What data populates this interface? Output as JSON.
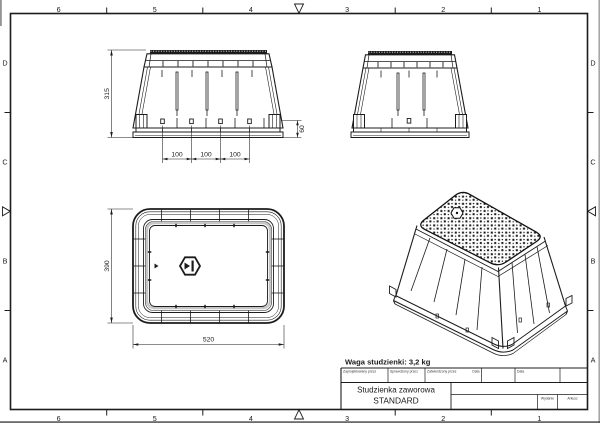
{
  "frame": {
    "columns": [
      "6",
      "5",
      "4",
      "3",
      "2",
      "1"
    ],
    "rows": [
      "D",
      "C",
      "B",
      "A"
    ]
  },
  "dims": {
    "front_height": "315",
    "front_base_height": "60",
    "front_spacing": [
      "100",
      "100",
      "100"
    ],
    "plan_depth": "390",
    "plan_width": "520"
  },
  "note": {
    "weight": "Waga studzienki: 3,2 kg"
  },
  "title_block": {
    "designed_by": "Zaprojektowany przez",
    "checked_by": "Sprawdzony przez",
    "approved_by": "Zatwierdzony przez",
    "date_1": "Data",
    "date_2": "Data",
    "product_line_1": "Studzienka zaworowa",
    "product_line_2": "STANDARD",
    "edition": "Wydanie",
    "sheet": "Arkusz"
  },
  "colors": {
    "ink": "#1c1c1c",
    "paper": "#ffffff",
    "shade": "#c6c6c6"
  }
}
